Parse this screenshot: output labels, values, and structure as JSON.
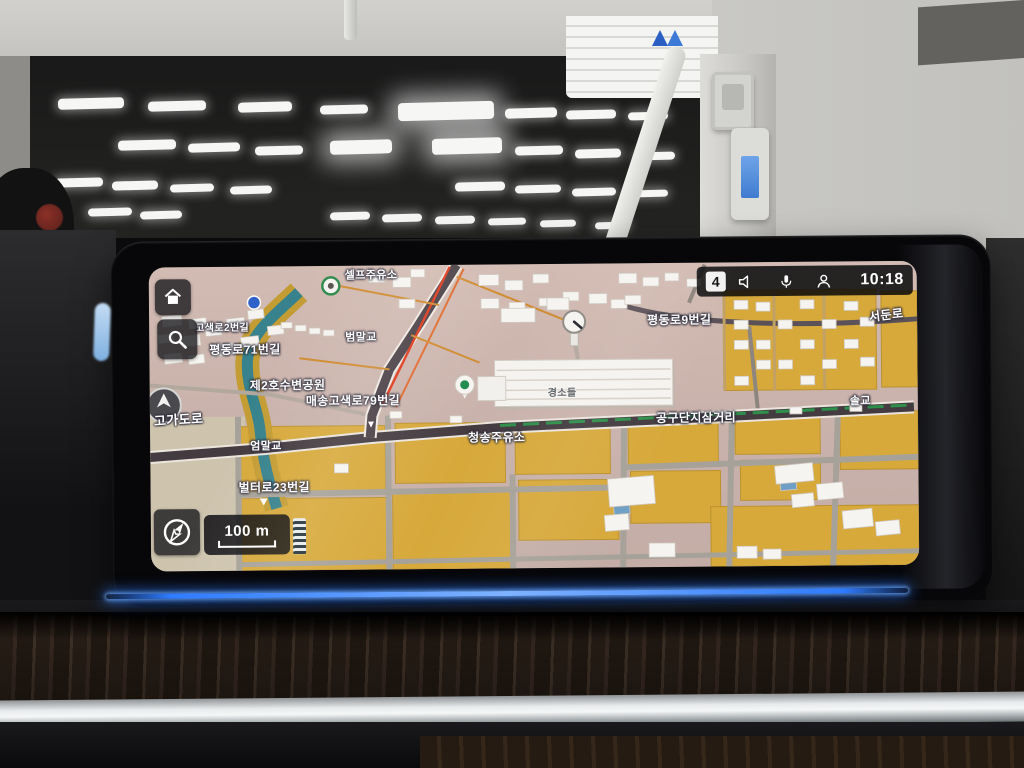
{
  "colors": {
    "led": "#2e7bff",
    "accent_blue": "#2f62c8",
    "map_field": "#d7a93b",
    "river": "#37828c",
    "route_red": "#e0391c",
    "route_green": "#2e8f4a"
  },
  "display": {
    "statusbar": {
      "badge": "4",
      "time": "10:18",
      "icons": [
        "volume-icon",
        "mic-icon",
        "profile-icon"
      ]
    },
    "controls": {
      "home_icon": "home-icon",
      "search_icon": "search-icon",
      "compass_icon": "compass-icon",
      "scale_label": "100 m"
    },
    "map": {
      "labels": [
        {
          "text": "셀프주유소",
          "x": 196,
          "y": 5,
          "size": 11
        },
        {
          "text": "고색로2번길",
          "x": 46,
          "y": 57,
          "size": 10
        },
        {
          "text": "평동로71번길",
          "x": 60,
          "y": 77,
          "size": 12
        },
        {
          "text": "범말교",
          "x": 196,
          "y": 67,
          "size": 11
        },
        {
          "text": "평동로9번길",
          "x": 498,
          "y": 51,
          "size": 12
        },
        {
          "text": "서둔로",
          "x": 720,
          "y": 48,
          "size": 12,
          "rot": -6
        },
        {
          "text": "제2호수변공원",
          "x": 100,
          "y": 113,
          "size": 12
        },
        {
          "text": "매송고색로79번길",
          "x": 156,
          "y": 129,
          "size": 12
        },
        {
          "text": "고가도로",
          "x": 4,
          "y": 146,
          "size": 13,
          "rot": -3
        },
        {
          "text": "경소들",
          "x": 398,
          "y": 125,
          "size": 10,
          "dark": true
        },
        {
          "text": "공구단지삼거리",
          "x": 506,
          "y": 149,
          "size": 12
        },
        {
          "text": "솔교",
          "x": 700,
          "y": 135,
          "size": 11
        },
        {
          "text": "청송주유소",
          "x": 318,
          "y": 167,
          "size": 12
        },
        {
          "text": "엄말교",
          "x": 100,
          "y": 175,
          "size": 11
        },
        {
          "text": "벌터로23번길",
          "x": 88,
          "y": 215,
          "size": 12
        }
      ]
    }
  }
}
